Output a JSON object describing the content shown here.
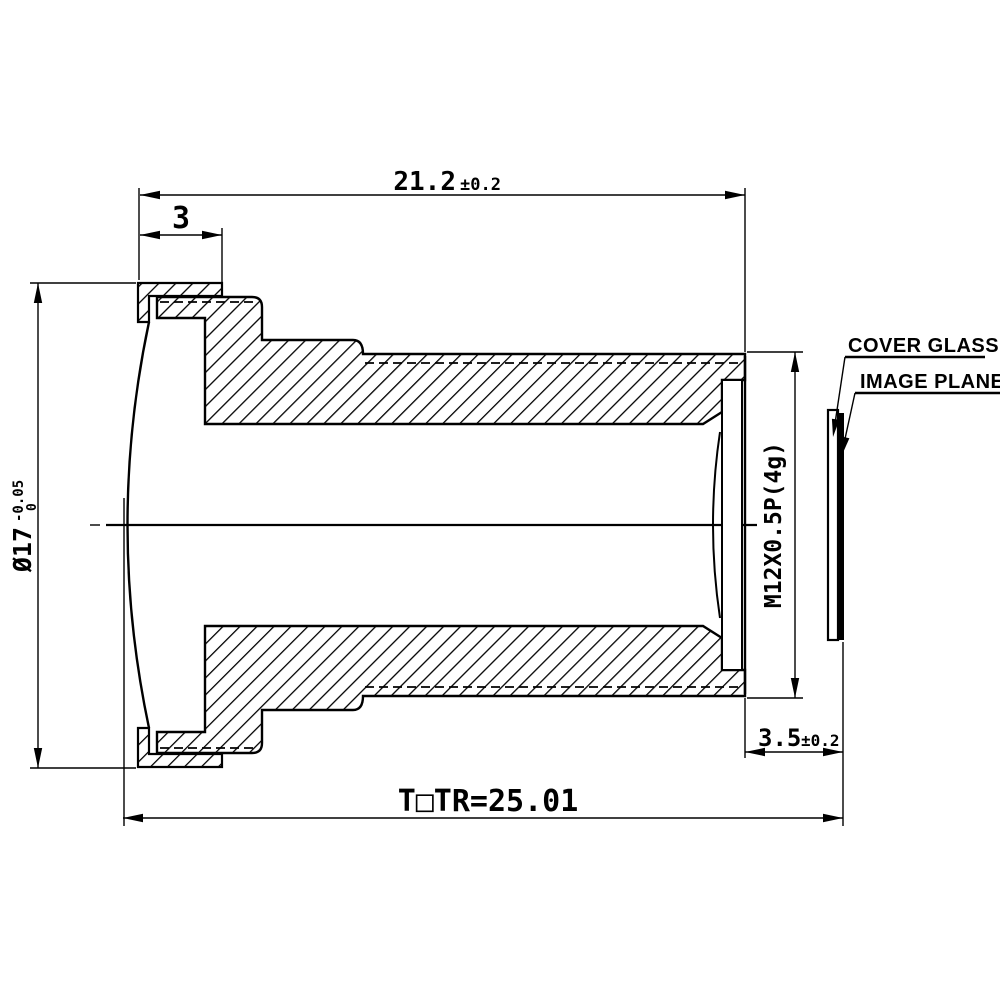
{
  "drawing": {
    "dim_overall_length": {
      "value": "21.2",
      "tol": "±0.2"
    },
    "dim_front_section": {
      "value": "3"
    },
    "dim_front_diameter": {
      "value": "Ø17",
      "tol_upper": "-0.05",
      "tol_lower": "0"
    },
    "dim_thread": {
      "value": "M12X0.5P(4g)"
    },
    "dim_back_distance": {
      "value": "3.5",
      "tol": "±0.2"
    },
    "dim_total_track": {
      "value": "T□TR=25.01"
    },
    "label_cover_glass": "COVER GLASS",
    "label_image_plane": "IMAGE PLANE",
    "colors": {
      "ink": "#000000",
      "paper": "#ffffff"
    }
  }
}
